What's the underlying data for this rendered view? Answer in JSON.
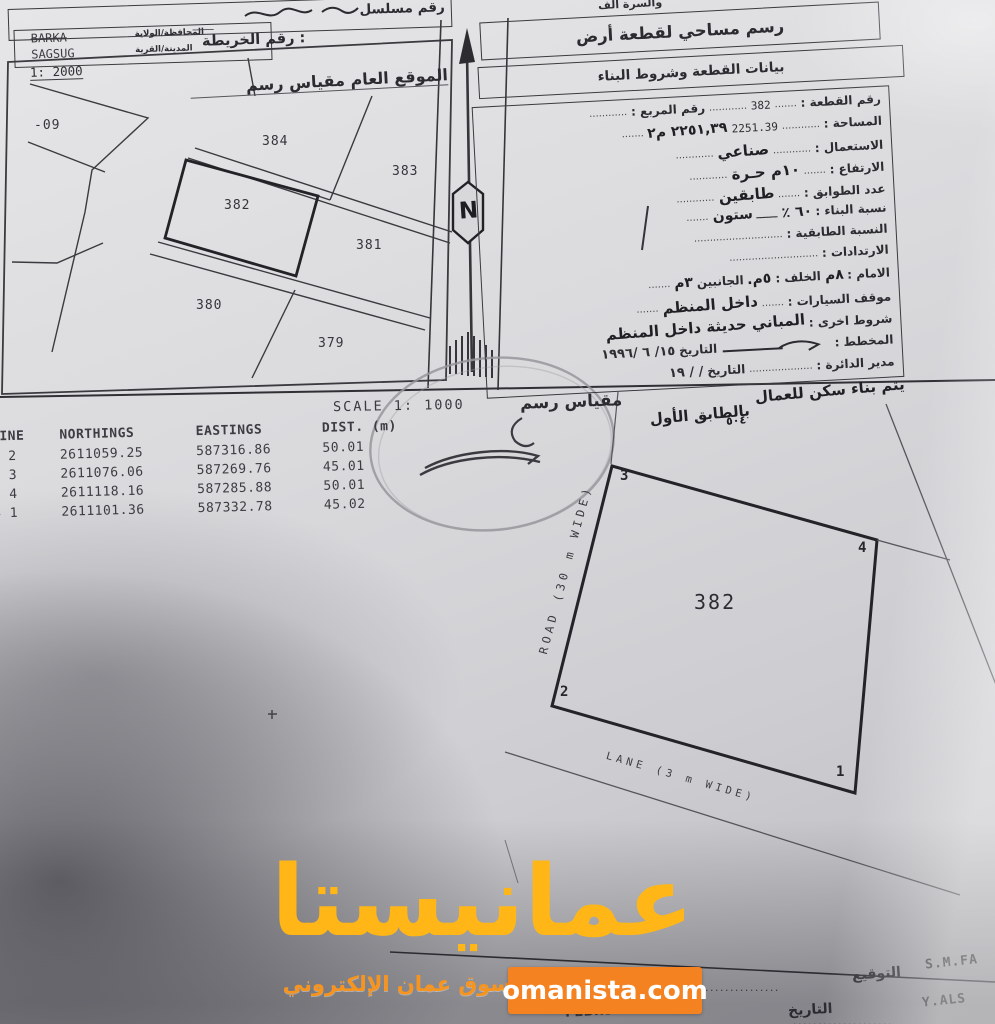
{
  "header": {
    "top_cut_text": "والسرة الف",
    "serial_label": "رقم مسلسل",
    "map_no_label": "رقم الخريطة :",
    "map_no_dash": "ــــــــ",
    "governorate_label": "المحافظة/الولاية",
    "governorate_value": "BARKA",
    "town_label": "المدينة/القرية",
    "town_value": "SAGSUG"
  },
  "titles": {
    "main": "رسم مساحي لقطعة أرض",
    "sub": "بيانات القطعة وشروط البناء"
  },
  "siteplan": {
    "scale": "1: 2000",
    "title": "الموقع العام مقياس رسم",
    "labels": {
      "p09": "-09",
      "p384": "384",
      "p383": "383",
      "p382": "382",
      "p381": "381",
      "p380": "380",
      "p379": "379"
    }
  },
  "north_letter": "N",
  "form": {
    "plot_no_label": "رقم القطعة :",
    "plot_no_value": "382",
    "square_no_label": "رقم المربع :",
    "area_label": "المساحة :",
    "area_typed": "2251.39",
    "area_hand": "٢٢٥١,٣٩ م٢",
    "use_label": "الاستعمال :",
    "use_value": "صناعي",
    "height_label": "الارتفاع :",
    "height_value": "١٠م حـرة",
    "floors_label": "عدد الطوابق :",
    "floors_value": "طابقين",
    "ratio_label": "نسبة البناء :",
    "ratio_value": "٦٠ ٪",
    "ratio_word": "ستون",
    "floor_ratio_label": "النسبة الطابقية :",
    "setbacks_label": "الارتدادات :",
    "front_label": "الامام :",
    "front_value": "٨م",
    "back_label": "الخلف :",
    "back_value": "٥م.",
    "sides_label": "الجانبين",
    "sides_value": "٣م",
    "parking_label": "موقف السيارات :",
    "parking_value": "داخل المنظم",
    "other_label": "شروط اخرى :",
    "other_value": "المباني حديثة داخل المنظم",
    "planner_label": "المخطط :",
    "planner_date_label": "التاريخ",
    "planner_date_value": "١٥/ ٦ /١٩٩٦",
    "director_label": "مدير الدائرة :",
    "director_date_label": "التاريخ",
    "director_date_value": "/      /      ١٩",
    "dash": "ــــــ",
    "dots7": ".......",
    "dots12": "............",
    "dots20": "....................",
    "dots28": "............................"
  },
  "scale_note": {
    "scale_en": "SCALE 1: 1000",
    "scale_ar": "مقياس رسم"
  },
  "hand_note": {
    "line1": "يتم بناء سكن للعمال",
    "line2": "بالطابق الأول",
    "line3": "٥٠٤"
  },
  "coords_table": {
    "headers": [
      "LINE",
      "NORTHINGS",
      "EASTINGS",
      "DIST. (m)"
    ],
    "rows": [
      [
        "1 2",
        "2611059.25",
        "587316.86",
        "50.01"
      ],
      [
        "2 3",
        "2611076.06",
        "587269.76",
        "45.01"
      ],
      [
        "3 4",
        "2611118.16",
        "587285.88",
        "50.01"
      ],
      [
        "4 1",
        "2611101.36",
        "587332.78",
        "45.02"
      ]
    ]
  },
  "plot": {
    "number": "382",
    "corners": [
      "1",
      "2",
      "3",
      "4"
    ],
    "road_label": "ROAD (30 m WIDE)",
    "lane_label": "LANE (3 m WIDE)"
  },
  "signature": {
    "sign_label": "التوقيع",
    "sign_value": "S.M.FA",
    "date_label": "التاريخ",
    "date_value": "Y.ALS",
    "date_hand": "FEB..9٤.."
  },
  "watermark": {
    "logo": "عمانيستا",
    "tagline": "سوق عمان الإلكتروني",
    "site": "omanista.com",
    "logo_color": "#ffb616",
    "box_color": "#f58220"
  }
}
